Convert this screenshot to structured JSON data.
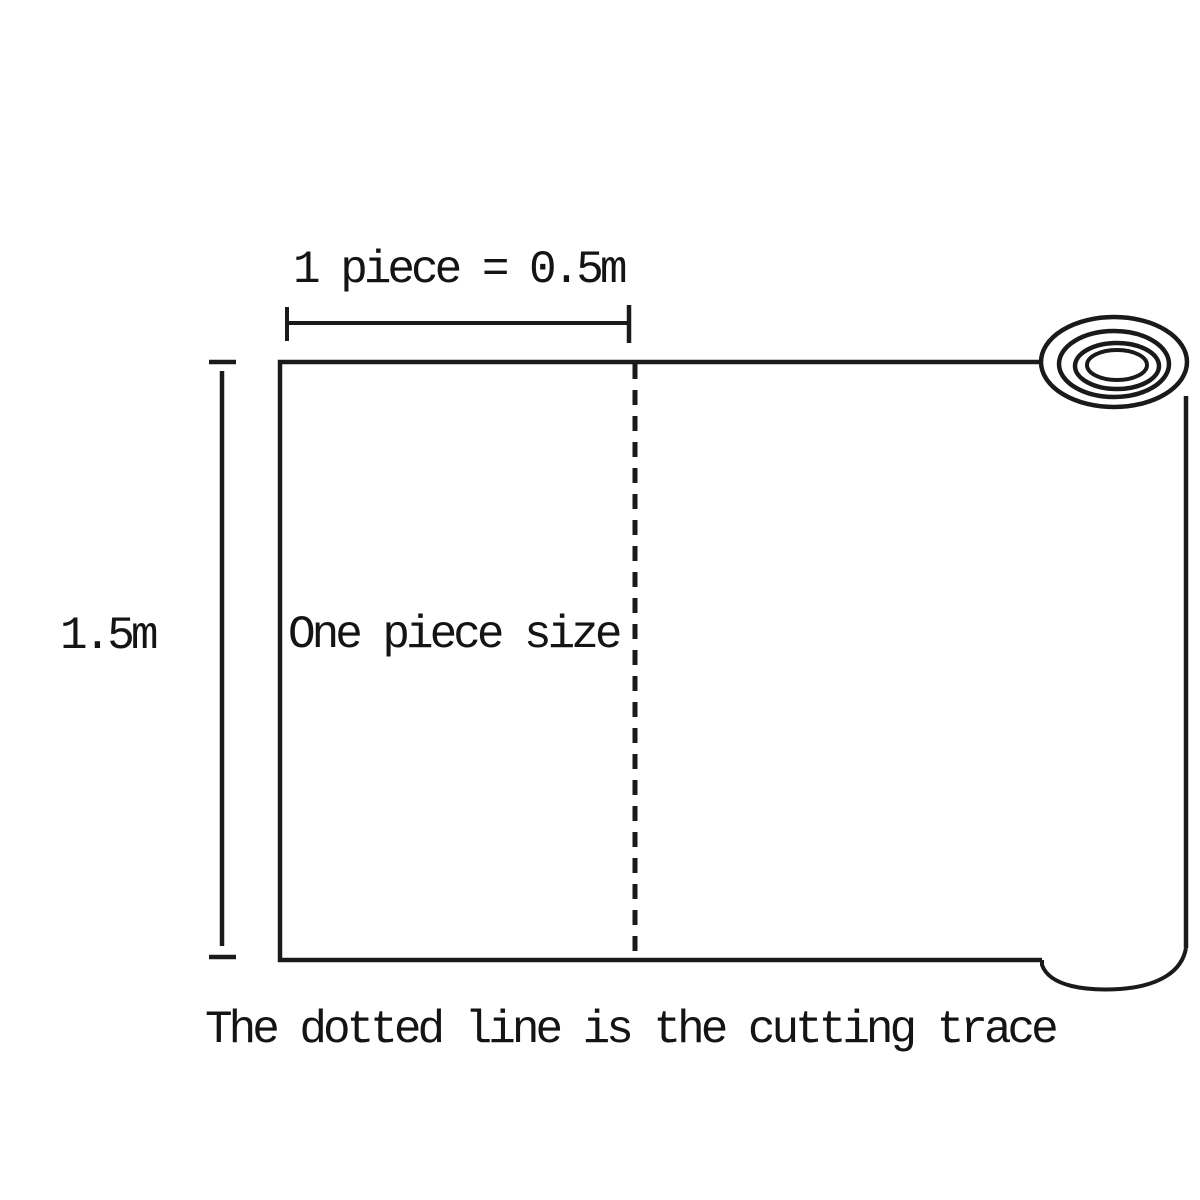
{
  "diagram": {
    "top_dimension_label": "1 piece = 0.5m",
    "height_dimension_label": "1.5m",
    "piece_label": "One piece size",
    "caption": "The dotted line is the cutting trace",
    "colors": {
      "line": "#1a1a1a",
      "text": "#141414",
      "background": "#ffffff"
    }
  }
}
